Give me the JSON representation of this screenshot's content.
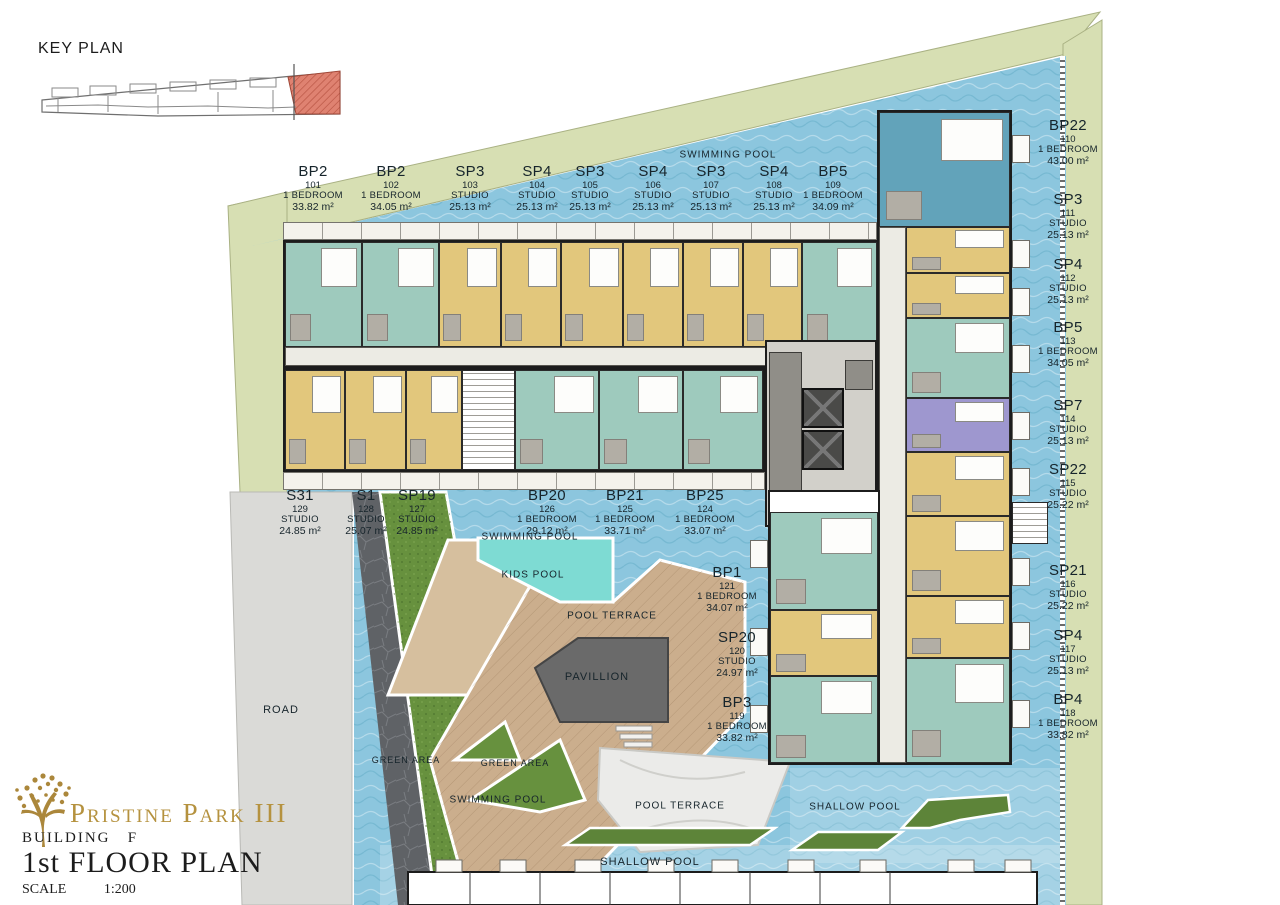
{
  "key_plan": {
    "title": "KEY PLAN"
  },
  "title_block": {
    "project": "Pristine Park III",
    "building_label": "BUILDING",
    "building_value": "F",
    "floor": "1st FLOOR PLAN",
    "scale_label": "SCALE",
    "scale_value": "1:200"
  },
  "units": [
    {
      "model": "BP2",
      "no": "101",
      "type": "1 BEDROOM",
      "area": "33.82 m²",
      "x": 313,
      "y": 164
    },
    {
      "model": "BP2",
      "no": "102",
      "type": "1 BEDROOM",
      "area": "34.05 m²",
      "x": 391,
      "y": 164
    },
    {
      "model": "SP3",
      "no": "103",
      "type": "STUDIO",
      "area": "25.13 m²",
      "x": 470,
      "y": 164
    },
    {
      "model": "SP4",
      "no": "104",
      "type": "STUDIO",
      "area": "25.13 m²",
      "x": 537,
      "y": 164
    },
    {
      "model": "SP3",
      "no": "105",
      "type": "STUDIO",
      "area": "25.13 m²",
      "x": 590,
      "y": 164
    },
    {
      "model": "SP4",
      "no": "106",
      "type": "STUDIO",
      "area": "25.13 m²",
      "x": 653,
      "y": 164
    },
    {
      "model": "SP3",
      "no": "107",
      "type": "STUDIO",
      "area": "25.13 m²",
      "x": 711,
      "y": 164
    },
    {
      "model": "SP4",
      "no": "108",
      "type": "STUDIO",
      "area": "25.13 m²",
      "x": 774,
      "y": 164
    },
    {
      "model": "BP5",
      "no": "109",
      "type": "1 BEDROOM",
      "area": "34.09 m²",
      "x": 833,
      "y": 164
    },
    {
      "model": "BP22",
      "no": "110",
      "type": "1 BEDROOM",
      "area": "43.00 m²",
      "x": 1068,
      "y": 118
    },
    {
      "model": "SP3",
      "no": "111",
      "type": "STUDIO",
      "area": "25.13 m²",
      "x": 1068,
      "y": 192
    },
    {
      "model": "SP4",
      "no": "112",
      "type": "STUDIO",
      "area": "25.13 m²",
      "x": 1068,
      "y": 257
    },
    {
      "model": "BP5",
      "no": "113",
      "type": "1 BEDROOM",
      "area": "34.05 m²",
      "x": 1068,
      "y": 320
    },
    {
      "model": "SP7",
      "no": "114",
      "type": "STUDIO",
      "area": "25.13 m²",
      "x": 1068,
      "y": 398
    },
    {
      "model": "SP22",
      "no": "115",
      "type": "STUDIO",
      "area": "25.22 m²",
      "x": 1068,
      "y": 462
    },
    {
      "model": "SP21",
      "no": "116",
      "type": "STUDIO",
      "area": "25.22 m²",
      "x": 1068,
      "y": 563
    },
    {
      "model": "SP4",
      "no": "117",
      "type": "STUDIO",
      "area": "25.13 m²",
      "x": 1068,
      "y": 628
    },
    {
      "model": "BP4",
      "no": "118",
      "type": "1 BEDROOM",
      "area": "33.82 m²",
      "x": 1068,
      "y": 692
    },
    {
      "model": "S31",
      "no": "129",
      "type": "STUDIO",
      "area": "24.85 m²",
      "x": 300,
      "y": 488
    },
    {
      "model": "S1",
      "no": "128",
      "type": "STUDIO",
      "area": "25.07 m²",
      "x": 366,
      "y": 488
    },
    {
      "model": "SP19",
      "no": "127",
      "type": "STUDIO",
      "area": "24.85 m²",
      "x": 417,
      "y": 488
    },
    {
      "model": "BP20",
      "no": "126",
      "type": "1 BEDROOM",
      "area": "29.12 m²",
      "x": 547,
      "y": 488
    },
    {
      "model": "BP21",
      "no": "125",
      "type": "1 BEDROOM",
      "area": "33.71 m²",
      "x": 625,
      "y": 488
    },
    {
      "model": "BP25",
      "no": "124",
      "type": "1 BEDROOM",
      "area": "33.07 m²",
      "x": 705,
      "y": 488
    },
    {
      "model": "BP1",
      "no": "121",
      "type": "1 BEDROOM",
      "area": "34.07 m²",
      "x": 727,
      "y": 565
    },
    {
      "model": "SP20",
      "no": "120",
      "type": "STUDIO",
      "area": "24.97 m²",
      "x": 737,
      "y": 630
    },
    {
      "model": "BP3",
      "no": "119",
      "type": "1 BEDROOM",
      "area": "33.82 m²",
      "x": 737,
      "y": 695
    }
  ],
  "area_labels": [
    {
      "id": "swimming-pool-top",
      "text": "SWIMMING POOL",
      "x": 728,
      "y": 155,
      "fs": 10
    },
    {
      "id": "swimming-pool-mid",
      "text": "SWIMMING POOL",
      "x": 530,
      "y": 537,
      "fs": 10
    },
    {
      "id": "kids-pool",
      "text": "KIDS POOL",
      "x": 533,
      "y": 575,
      "fs": 10
    },
    {
      "id": "pool-terrace-mid",
      "text": "POOL TERRACE",
      "x": 612,
      "y": 616,
      "fs": 10
    },
    {
      "id": "pavillion",
      "text": "PAVILLION",
      "x": 597,
      "y": 677,
      "fs": 11
    },
    {
      "id": "road",
      "text": "ROAD",
      "x": 281,
      "y": 710,
      "fs": 11
    },
    {
      "id": "green-area-left",
      "text": "GREEN AREA",
      "x": 406,
      "y": 760,
      "fs": 9
    },
    {
      "id": "green-area-right",
      "text": "GREEN AREA",
      "x": 515,
      "y": 763,
      "fs": 9
    },
    {
      "id": "swimming-pool-bottom",
      "text": "SWIMMING POOL",
      "x": 498,
      "y": 800,
      "fs": 10
    },
    {
      "id": "pool-terrace-bottom",
      "text": "POOL TERRACE",
      "x": 680,
      "y": 806,
      "fs": 10
    },
    {
      "id": "shallow-pool-right",
      "text": "SHALLOW POOL",
      "x": 855,
      "y": 807,
      "fs": 10
    },
    {
      "id": "shallow-pool-bottom",
      "text": "SHALLOW POOL",
      "x": 650,
      "y": 862,
      "fs": 11
    }
  ]
}
